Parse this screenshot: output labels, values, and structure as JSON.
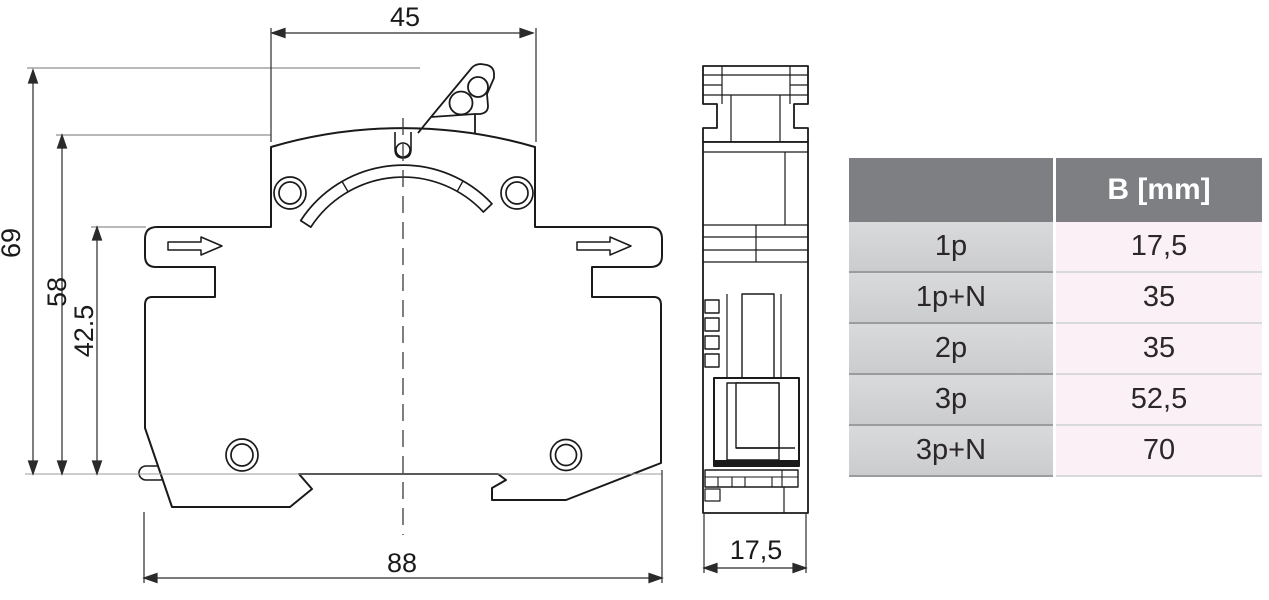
{
  "drawing": {
    "front_view": {
      "dim_top_width": "45",
      "dim_overall_height": "69",
      "dim_body_height": "58",
      "dim_lower_height": "42.5",
      "dim_bottom_width": "88"
    },
    "side_view": {
      "dim_width": "17,5"
    }
  },
  "table": {
    "header": {
      "spec_col": "",
      "value_col": "B [mm]"
    },
    "rows": [
      {
        "label": "1p",
        "value": "17,5"
      },
      {
        "label": "1p+N",
        "value": "35"
      },
      {
        "label": "2p",
        "value": "35"
      },
      {
        "label": "3p",
        "value": "52,5"
      },
      {
        "label": "3p+N",
        "value": "70"
      }
    ]
  },
  "colors": {
    "table_header_bg": "#7d7f82",
    "table_label_bg": "#d2d3d4",
    "table_value_bg": "#faf0f5",
    "line": "#1a1a1a",
    "dim_line": "#2a2a2a",
    "extension_line": "#8f8f8f"
  }
}
